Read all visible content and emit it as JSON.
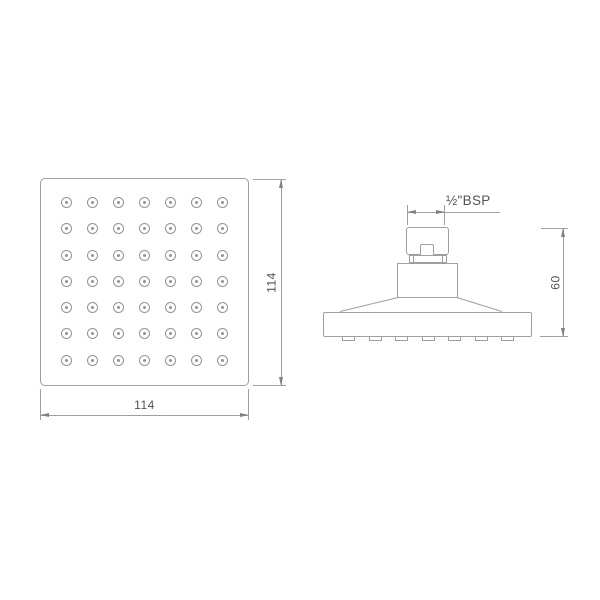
{
  "drawing": {
    "colors": {
      "line": "#9aa0a3",
      "arrow": "#7e8386",
      "text": "#4f5456",
      "background": "#ffffff"
    },
    "front_view": {
      "nozzle_grid": {
        "rows": 7,
        "cols": 7
      },
      "width_dim_label": "114",
      "height_dim_label": "114"
    },
    "side_view": {
      "thread_label": "½\"BSP",
      "height_dim_label": "60",
      "nozzle_tab_count": 7
    }
  }
}
